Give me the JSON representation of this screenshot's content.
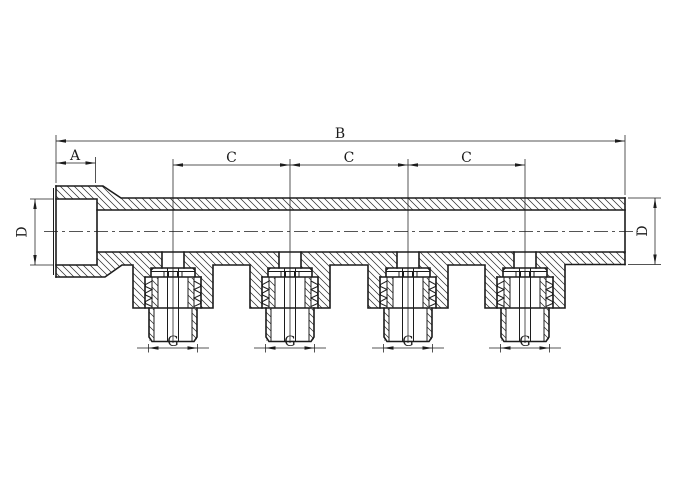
{
  "labels": {
    "overall_length": "B",
    "inlet_depth": "A",
    "port_spacing": [
      "C",
      "C",
      "C"
    ],
    "diameter_left": "D",
    "diameter_right": "D",
    "outlet_thread": [
      "G",
      "G",
      "G",
      "G"
    ]
  },
  "colors": {
    "background": "#ffffff",
    "line": "#1c1c1c"
  }
}
